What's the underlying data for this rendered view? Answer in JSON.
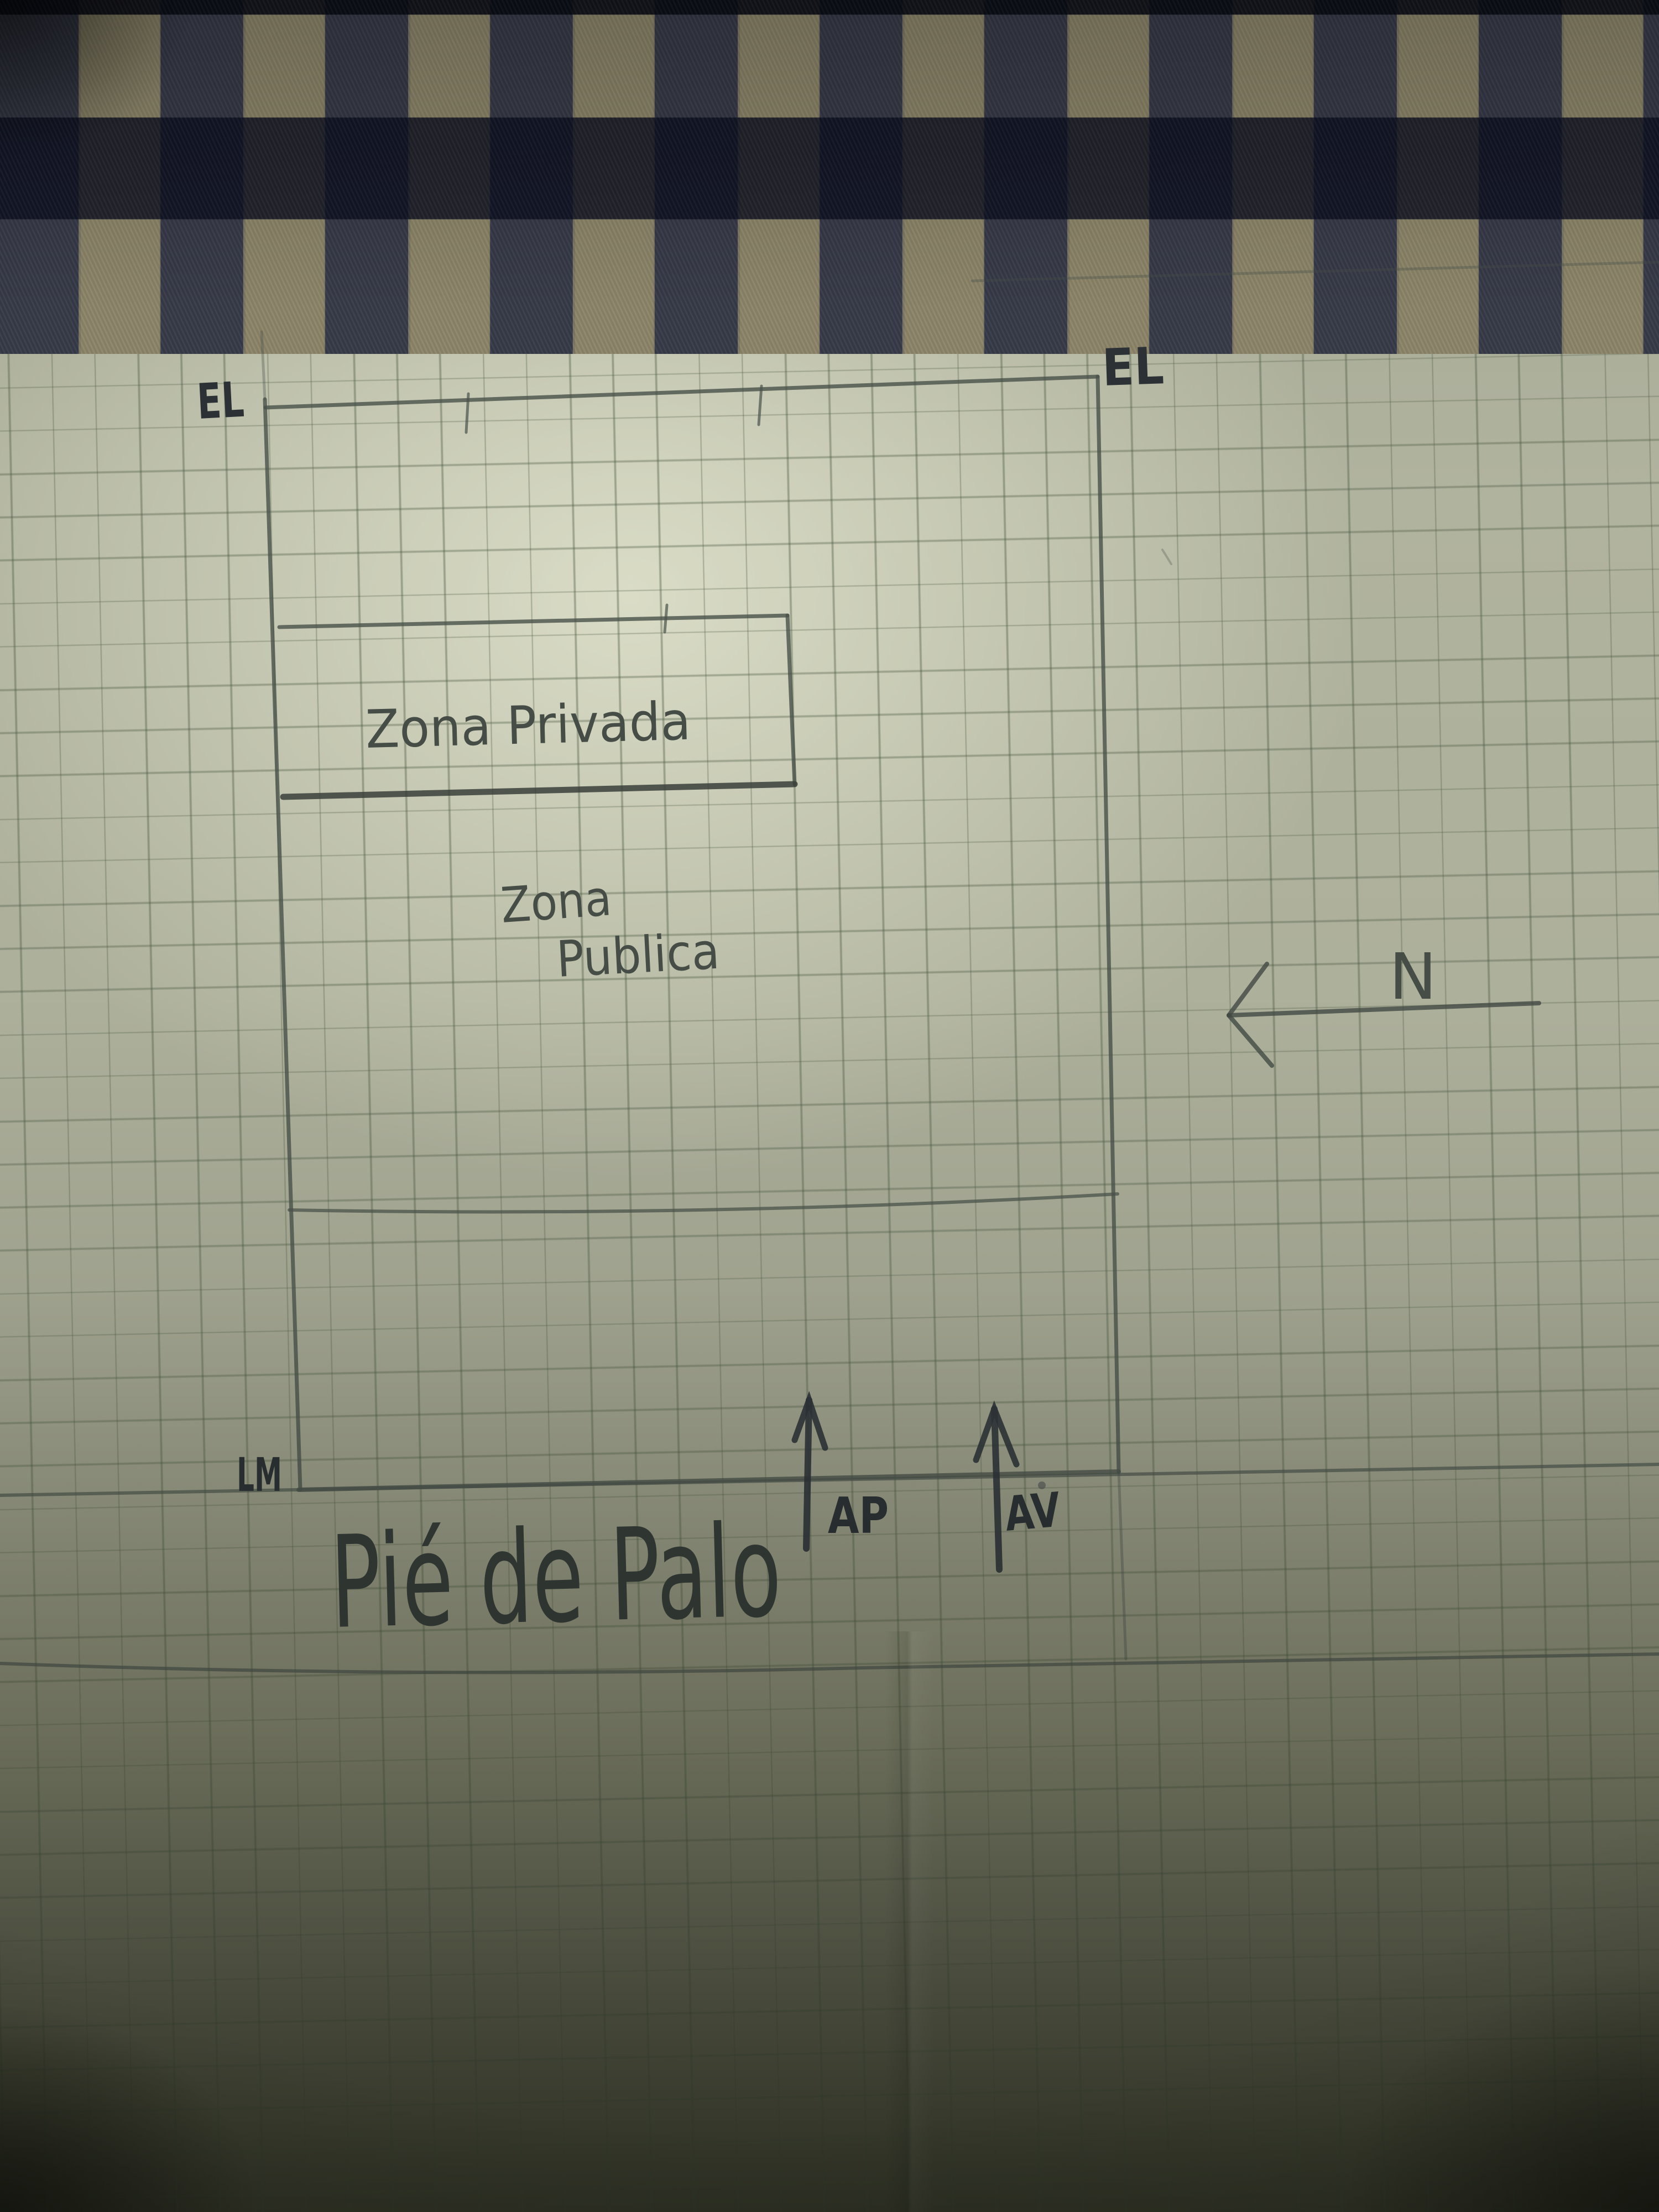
{
  "sketch": {
    "corner_label_top_left": "EL",
    "corner_label_top_right": "EL",
    "municipal_line_label": "LM",
    "private_zone_label": "Zona Privada",
    "public_zone_label_line1": "Zona",
    "public_zone_label_line2": "Publica",
    "street_name": "Pié de Palo",
    "north_label": "N",
    "access_arrow_left_label": "AP",
    "access_arrow_right_label": "AV"
  },
  "colors": {
    "paper": "#b0b39e",
    "grid_line": "#6d7a62",
    "pencil": "#49514a",
    "pencil_bold": "#39403a",
    "ink_dark": "#2b3134",
    "fabric_tan": "#8b8468",
    "fabric_navy": "#1d2336"
  }
}
